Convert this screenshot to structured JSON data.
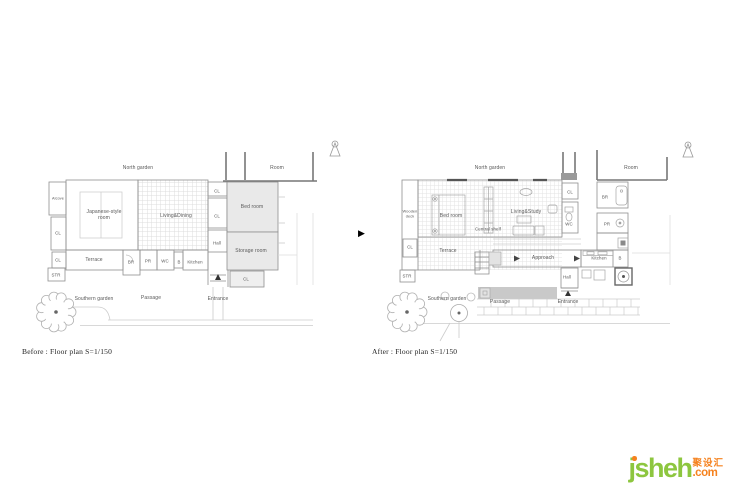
{
  "captions": {
    "before": "Before : Floor plan S=1/150",
    "after": "After : Floor plan S=1/150"
  },
  "transition_arrow": "▶",
  "watermark": {
    "brand": "jsheh",
    "tld": ".com",
    "cn": "聚设汇",
    "green": "#8dc63f",
    "orange": "#f5821f"
  },
  "before": {
    "north_garden": "North garden",
    "room": "Room",
    "alcove": "Alcove",
    "japanese_room": "Japanese-style\nroom",
    "living_dining": "Living&Dining",
    "cl": "CL",
    "bed_room": "Bed room",
    "hall": "Hall",
    "storage_room": "Storage room",
    "terrace": "Terrace",
    "br": "BR",
    "pr": "PR",
    "wc": "WC",
    "b": "B",
    "kitchen": "Kitchen",
    "str": "STR",
    "southern_garden": "Southern garden",
    "passage": "Passage",
    "entrance": "Entrance"
  },
  "after": {
    "north_garden": "North garden",
    "room": "Room",
    "wooden_deck": "Wooden\ndeck",
    "bed_room": "Bed room",
    "central_shelf": "Central shelf",
    "living_study": "Living&Study",
    "cl": "CL",
    "wc": "WC",
    "br": "BR",
    "pr": "PR",
    "b": "B",
    "kitchen": "Kitchen",
    "approach": "Approach",
    "terrace": "Terrace",
    "str": "STR",
    "hall": "Hall",
    "southern_garden": "Southern garden",
    "passage": "Passage",
    "entrance": "Entrance"
  }
}
